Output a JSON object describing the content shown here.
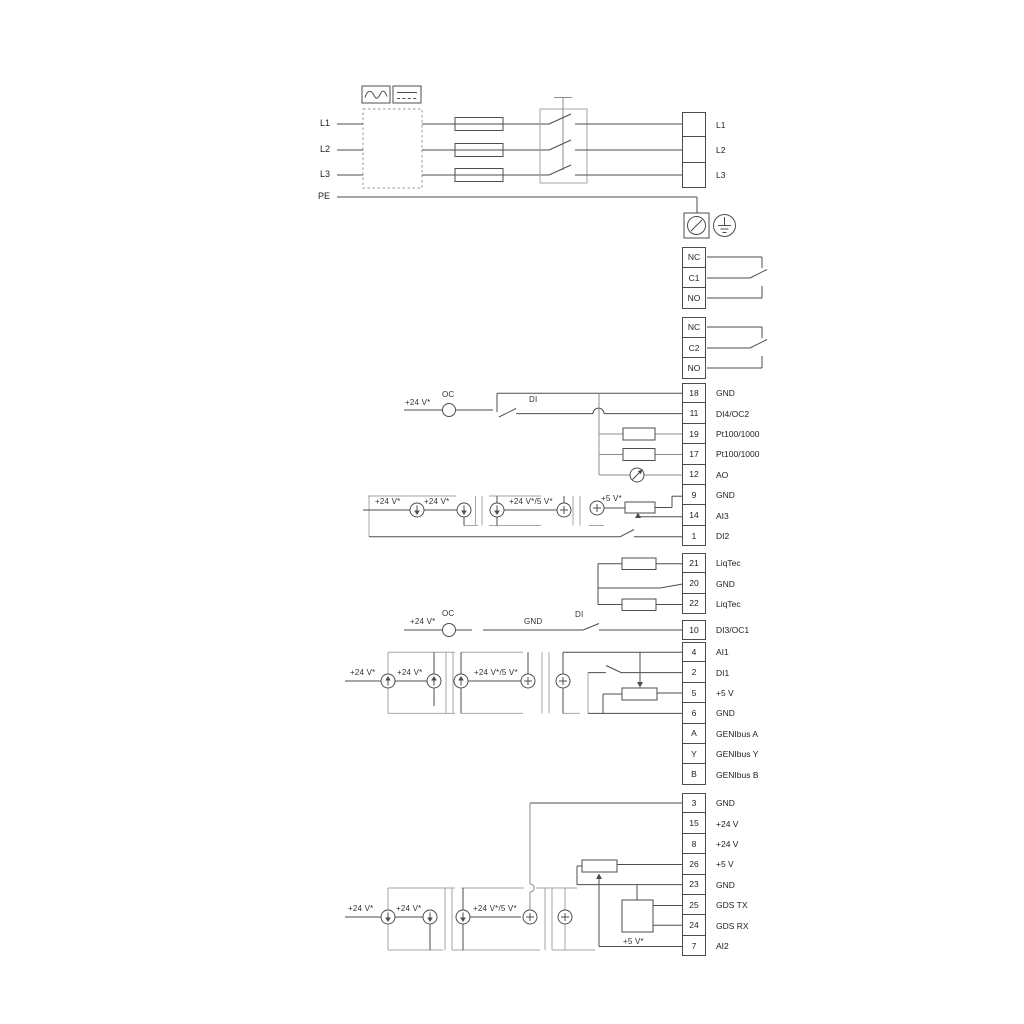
{
  "power": {
    "inputs": [
      "L1",
      "L2",
      "L3"
    ],
    "pe": "PE",
    "outputs": [
      "L1",
      "L2",
      "L3"
    ]
  },
  "relay1": [
    "NC",
    "C1",
    "NO"
  ],
  "relay2": [
    "NC",
    "C2",
    "NO"
  ],
  "io1": [
    {
      "n": "18",
      "label": "GND"
    },
    {
      "n": "11",
      "label": "DI4/OC2"
    },
    {
      "n": "19",
      "label": "Pt100/1000"
    },
    {
      "n": "17",
      "label": "Pt100/1000"
    },
    {
      "n": "12",
      "label": "AO"
    },
    {
      "n": "9",
      "label": "GND"
    },
    {
      "n": "14",
      "label": "AI3"
    },
    {
      "n": "1",
      "label": "DI2"
    }
  ],
  "liqtec": [
    {
      "n": "21",
      "label": "LiqTec"
    },
    {
      "n": "20",
      "label": "GND"
    },
    {
      "n": "22",
      "label": "LiqTec"
    }
  ],
  "di3": [
    {
      "n": "10",
      "label": "DI3/OC1"
    }
  ],
  "io2": [
    {
      "n": "4",
      "label": "AI1"
    },
    {
      "n": "2",
      "label": "DI1"
    },
    {
      "n": "5",
      "label": "+5 V"
    },
    {
      "n": "6",
      "label": "GND"
    },
    {
      "n": "A",
      "label": "GENIbus A"
    },
    {
      "n": "Y",
      "label": "GENIbus Y"
    },
    {
      "n": "B",
      "label": "GENIbus B"
    }
  ],
  "io3": [
    {
      "n": "3",
      "label": "GND"
    },
    {
      "n": "15",
      "label": "+24 V"
    },
    {
      "n": "8",
      "label": "+24 V"
    },
    {
      "n": "26",
      "label": "+5 V"
    },
    {
      "n": "23",
      "label": "GND"
    },
    {
      "n": "25",
      "label": "GDS TX"
    },
    {
      "n": "24",
      "label": "GDS RX"
    },
    {
      "n": "7",
      "label": "AI2"
    }
  ],
  "ann": {
    "v24": "+24 V*",
    "v24_5": "+24 V*/5 V*",
    "v5": "+5 V*",
    "oc": "OC",
    "di": "DI",
    "gnd": "GND"
  },
  "colors": {
    "line": "#4d4d4d",
    "gray": "#a6a6a6"
  }
}
